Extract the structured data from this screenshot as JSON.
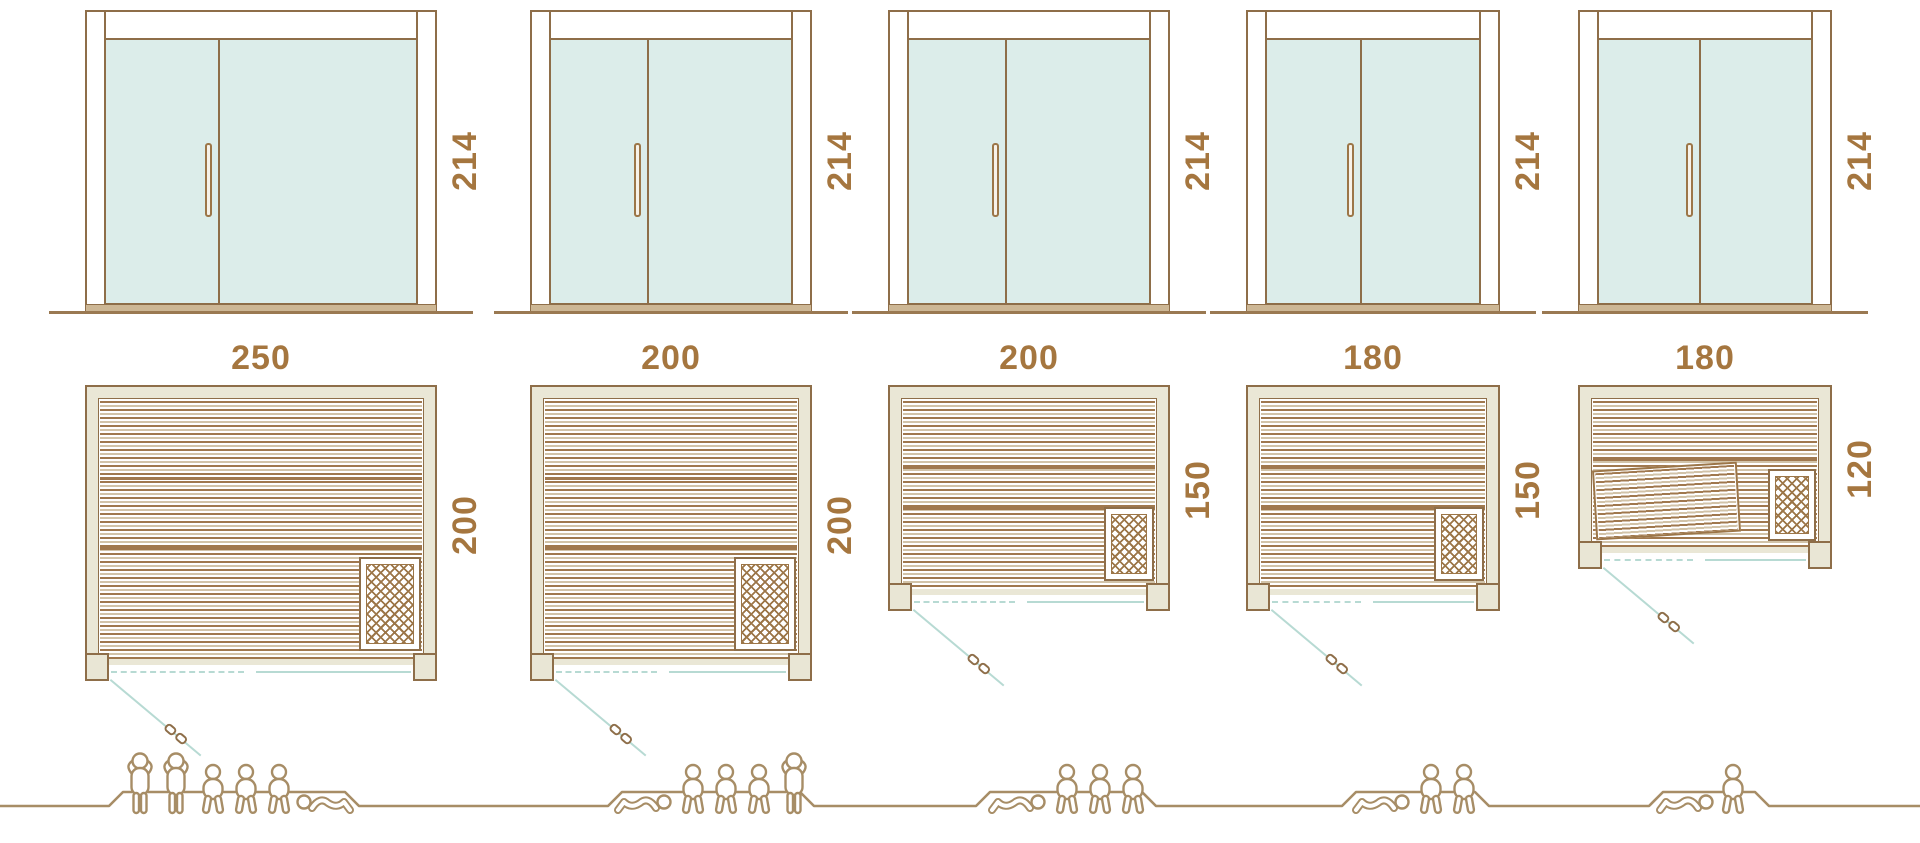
{
  "diagram": "sauna-size-comparison",
  "unit_count": 5,
  "saunas": [
    {
      "name": "sauna-250x200",
      "width": "250",
      "depth": "200",
      "door_height": "214",
      "people": {
        "standing": 2,
        "sitting": 3,
        "lying": 1,
        "total": 6
      }
    },
    {
      "name": "sauna-200x200",
      "width": "200",
      "depth": "200",
      "door_height": "214",
      "people": {
        "standing": 1,
        "sitting": 3,
        "lying": 1,
        "total": 5
      }
    },
    {
      "name": "sauna-200x150",
      "width": "200",
      "depth": "150",
      "door_height": "214",
      "people": {
        "standing": 0,
        "sitting": 3,
        "lying": 1,
        "total": 4
      }
    },
    {
      "name": "sauna-180x150",
      "width": "180",
      "depth": "150",
      "door_height": "214",
      "people": {
        "standing": 0,
        "sitting": 2,
        "lying": 1,
        "total": 3
      }
    },
    {
      "name": "sauna-180x120",
      "width": "180",
      "depth": "120",
      "door_height": "214",
      "people": {
        "standing": 0,
        "sitting": 1,
        "lying": 1,
        "total": 2
      }
    }
  ],
  "icons": [
    "door-elevation",
    "floor-plan",
    "heater-grill",
    "swing-door",
    "person-standing-icon",
    "person-sitting-icon",
    "person-lying-icon"
  ],
  "colors": {
    "outline_brown": "#8e6e49",
    "slat_brown": "#a0784e",
    "slat_light": "#d2c3a8",
    "wall_beige": "#eae7d6",
    "glass_teal": "#dcedea",
    "line_teal": "#b7dad3",
    "label_brown": "#a5763f",
    "people_brown": "#a78d66"
  }
}
